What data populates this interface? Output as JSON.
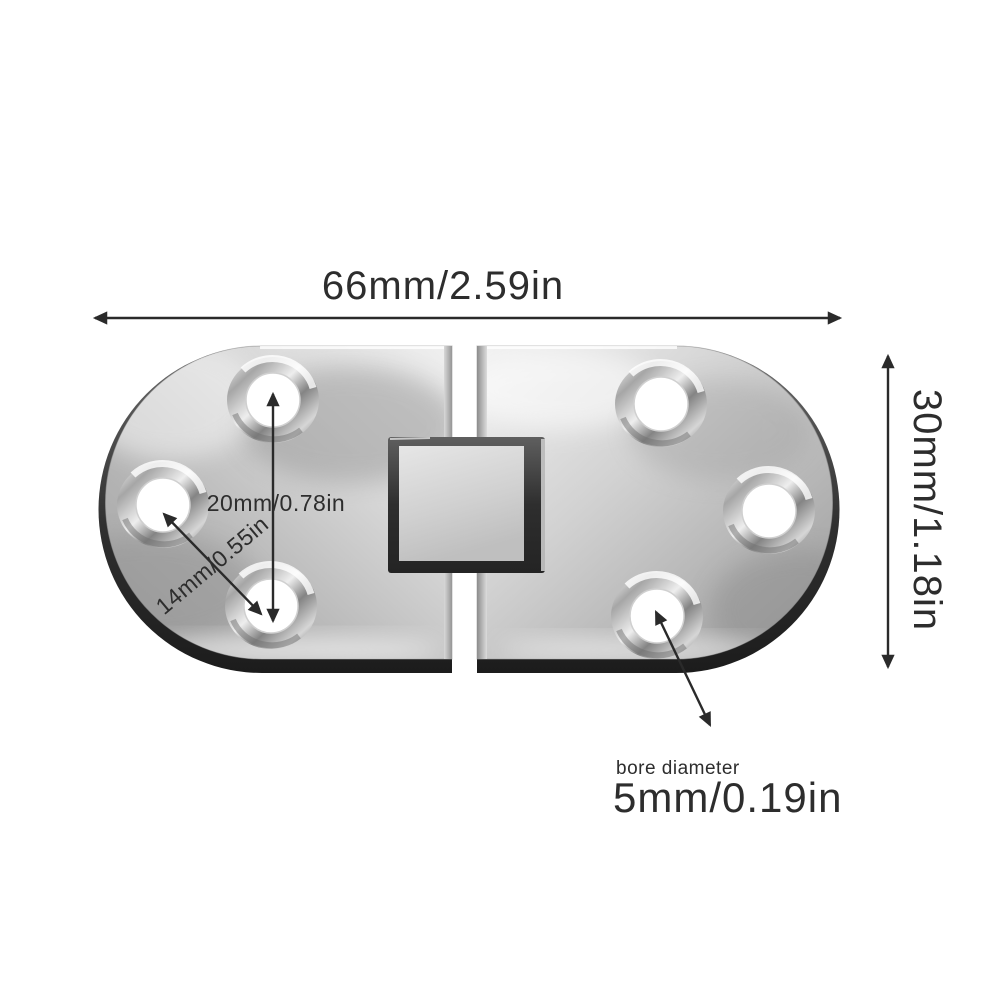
{
  "image": {
    "type": "product-dimension-diagram",
    "subject": "stainless-steel flip-top hinge, top view, six countersunk screw holes, square center knuckle"
  },
  "annotations": {
    "width_label": "66mm/2.59in",
    "height_label": "30mm/1.18in",
    "vertical_hole_spacing_label": "20mm/0.78in",
    "diagonal_hole_spacing_label": "14mm/0.55in",
    "bore_caption": "bore diameter",
    "bore_label": "5mm/0.19in"
  },
  "colors": {
    "background": "#ffffff",
    "annotation_text": "#2d2d2d",
    "dimension_arrow": "#2a2a2a",
    "metal_highlight": "#f2f2f2",
    "metal_mid": "#c0c0c0",
    "metal_shadow": "#8f8f8f",
    "metal_edge_dark": "#2b2b2b"
  }
}
